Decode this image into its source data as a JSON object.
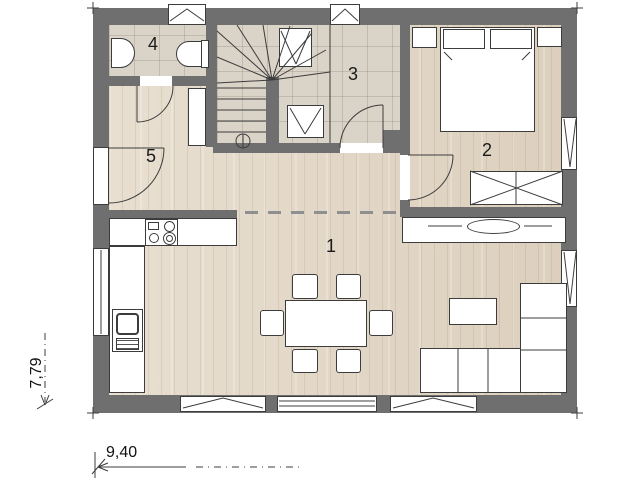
{
  "plan": {
    "type": "architectural-floor-plan",
    "rooms": [
      {
        "number": "1",
        "name": "living-dining-kitchen"
      },
      {
        "number": "2",
        "name": "bedroom"
      },
      {
        "number": "3",
        "name": "stair-hall"
      },
      {
        "number": "4",
        "name": "bathroom"
      },
      {
        "number": "5",
        "name": "entrance-hall"
      }
    ],
    "dimensions": {
      "vertical_m": "7,79",
      "horizontal_m": "9,40"
    },
    "colors": {
      "wall": "#6f6f6f",
      "wood_floor": "#e5dbcc",
      "tile_floor": "#dad3c8",
      "outline": "#3c3c3c",
      "furniture_fill": "#ffffff"
    },
    "furniture": [
      "bed",
      "pillows",
      "nightstand-left",
      "nightstand-right",
      "wardrobe",
      "sideboard-with-tv",
      "sofa-l-shaped",
      "coffee-table",
      "dining-table",
      "six-chairs",
      "kitchen-counter",
      "stove-4-burners",
      "sink-unit",
      "washbasin",
      "toilet",
      "winder-staircase"
    ]
  }
}
